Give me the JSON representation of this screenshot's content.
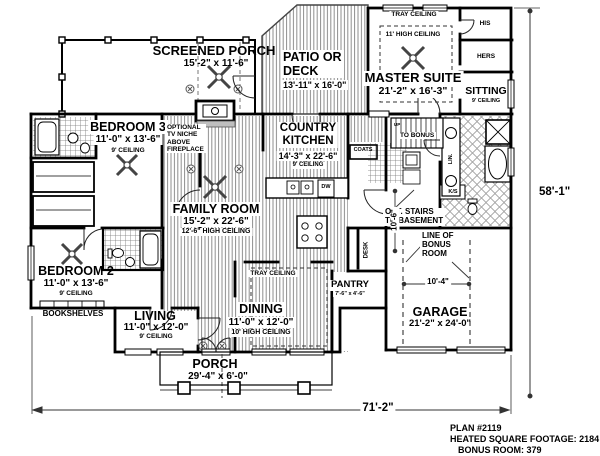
{
  "title_block": {
    "plan_number": "PLAN #2119",
    "heated_sqft": "HEATED SQUARE FOOTAGE: 2184",
    "bonus_room": "BONUS ROOM: 379"
  },
  "overall_dims": {
    "width": "71'-2\"",
    "depth": "58'-1\""
  },
  "rooms": {
    "screened_porch": {
      "name": "SCREENED PORCH",
      "dims": "15'-2\" x 11'-6\""
    },
    "patio": {
      "name": "PATIO OR\nDECK",
      "dims": "13'-11\" x 16'-0\""
    },
    "master": {
      "name": "MASTER SUITE",
      "dims": "21'-2\" x 16'-3\"",
      "tray": "TRAY CEILING",
      "ceiling": "11' HIGH CEILING"
    },
    "his": "HIS",
    "hers": "HERS",
    "sitting": {
      "name": "SITTING",
      "ceiling": "9' CEILING"
    },
    "bedroom3": {
      "name": "BEDROOM 3",
      "dims": "11'-0\" x 13'-6\"",
      "ceiling": "9' CEILING"
    },
    "kitchen": {
      "name": "COUNTRY\nKITCHEN",
      "dims": "14'-3\" x 22'-6\"",
      "ceiling": "9' CEILING"
    },
    "family": {
      "name": "FAMILY ROOM",
      "dims": "15'-2\" x 22'-6\"",
      "ceiling": "12'-6\" HIGH CEILING"
    },
    "bedroom2": {
      "name": "BEDROOM 2",
      "dims": "11'-0\" x 13'-6\"",
      "ceiling": "9' CEILING"
    },
    "living": {
      "name": "LIVING",
      "dims": "11'-0\" x 12'-0\"",
      "ceiling": "9' CEILING"
    },
    "dining": {
      "name": "DINING",
      "dims": "11'-0\" x 12'-0\"",
      "ceiling": "10' HIGH CEILING",
      "tray": "TRAY CEILING"
    },
    "pantry": {
      "name": "PANTRY",
      "dims": "7'-6\" x 4'-6\""
    },
    "porch": {
      "name": "PORCH",
      "dims": "29'-4\" x 6'-0\""
    },
    "garage": {
      "name": "GARAGE",
      "dims": "21'-2\" x 24'-0\""
    }
  },
  "annotations": {
    "tv_niche": "OPTIONAL\nTV NICHE\nABOVE\nFIREPLACE",
    "bookshelves": "BOOKSHELVES",
    "opt_stairs": "OPT. STAIRS\nTO BASEMENT",
    "bonus_line": "LINE OF\nBONUS\nROOM",
    "up": "UP",
    "to_bonus": "TO BONUS",
    "coats": "COATS",
    "lin": "LIN.",
    "ks": "K/S",
    "desk": "DESK",
    "dw": "DW",
    "dim_10_4": "10'-4\"",
    "dim_10_6": "10'-6\""
  }
}
